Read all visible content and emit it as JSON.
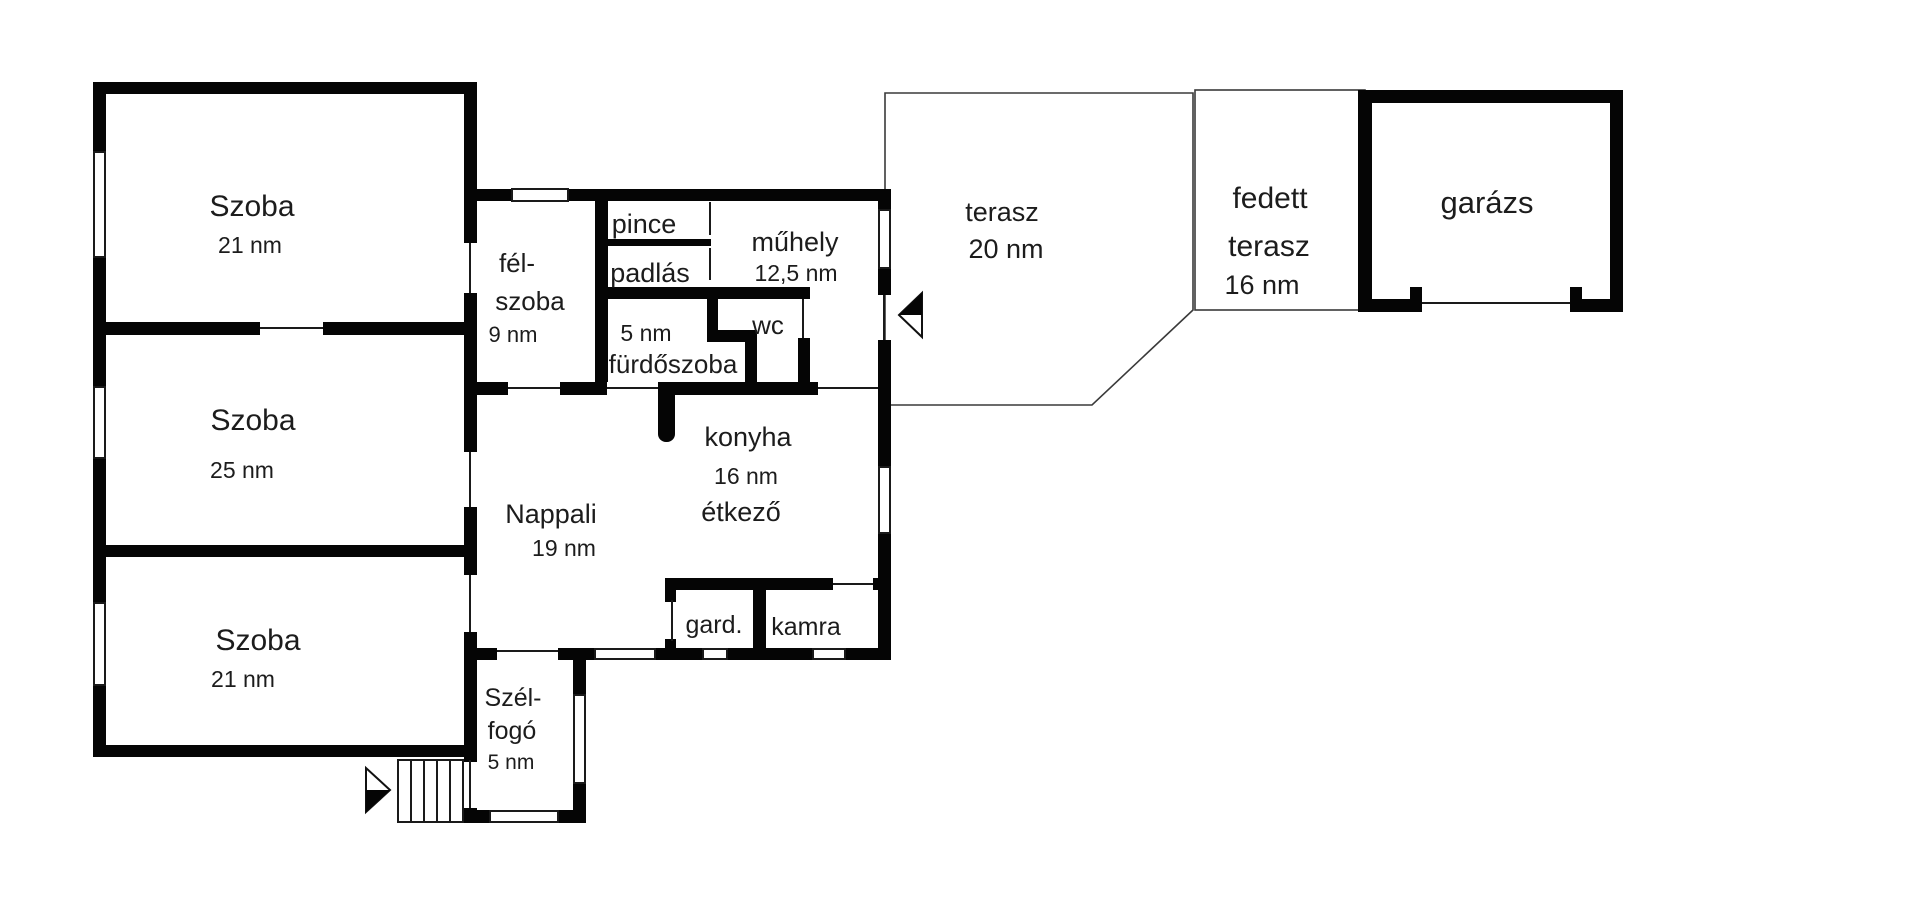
{
  "title": "floor-plan",
  "colors": {
    "wall": "#050505",
    "background": "#ffffff",
    "text": "#1c1c1c"
  },
  "rooms": {
    "szoba_top": {
      "name": "Szoba",
      "area": "21 nm"
    },
    "szoba_middle": {
      "name": "Szoba",
      "area": "25 nm"
    },
    "szoba_bottom": {
      "name": "Szoba",
      "area": "21 nm"
    },
    "felszoba": {
      "name_line1": "fél-",
      "name_line2": "szoba",
      "area": "9 nm"
    },
    "pince": {
      "name": "pince"
    },
    "padlas": {
      "name": "padlás"
    },
    "muhely": {
      "name": "műhely",
      "area": "12,5 nm"
    },
    "wc": {
      "name": "wc"
    },
    "furdoszoba": {
      "area": "5 nm",
      "name": "fürdőszoba"
    },
    "konyha": {
      "name": "konyha",
      "area": "16 nm",
      "subname": "étkező"
    },
    "nappali": {
      "name": "Nappali",
      "area": "19 nm"
    },
    "gardrob": {
      "name": "gard."
    },
    "kamra": {
      "name": "kamra"
    },
    "szelfogo": {
      "name_line1": "Szél-",
      "name_line2": "fogó",
      "area": "5 nm"
    },
    "terasz": {
      "name": "terasz",
      "area": "20 nm"
    },
    "fedett_terasz": {
      "name_line1": "fedett",
      "name_line2": "terasz",
      "area": "16 nm"
    },
    "garazs": {
      "name": "garázs"
    }
  }
}
